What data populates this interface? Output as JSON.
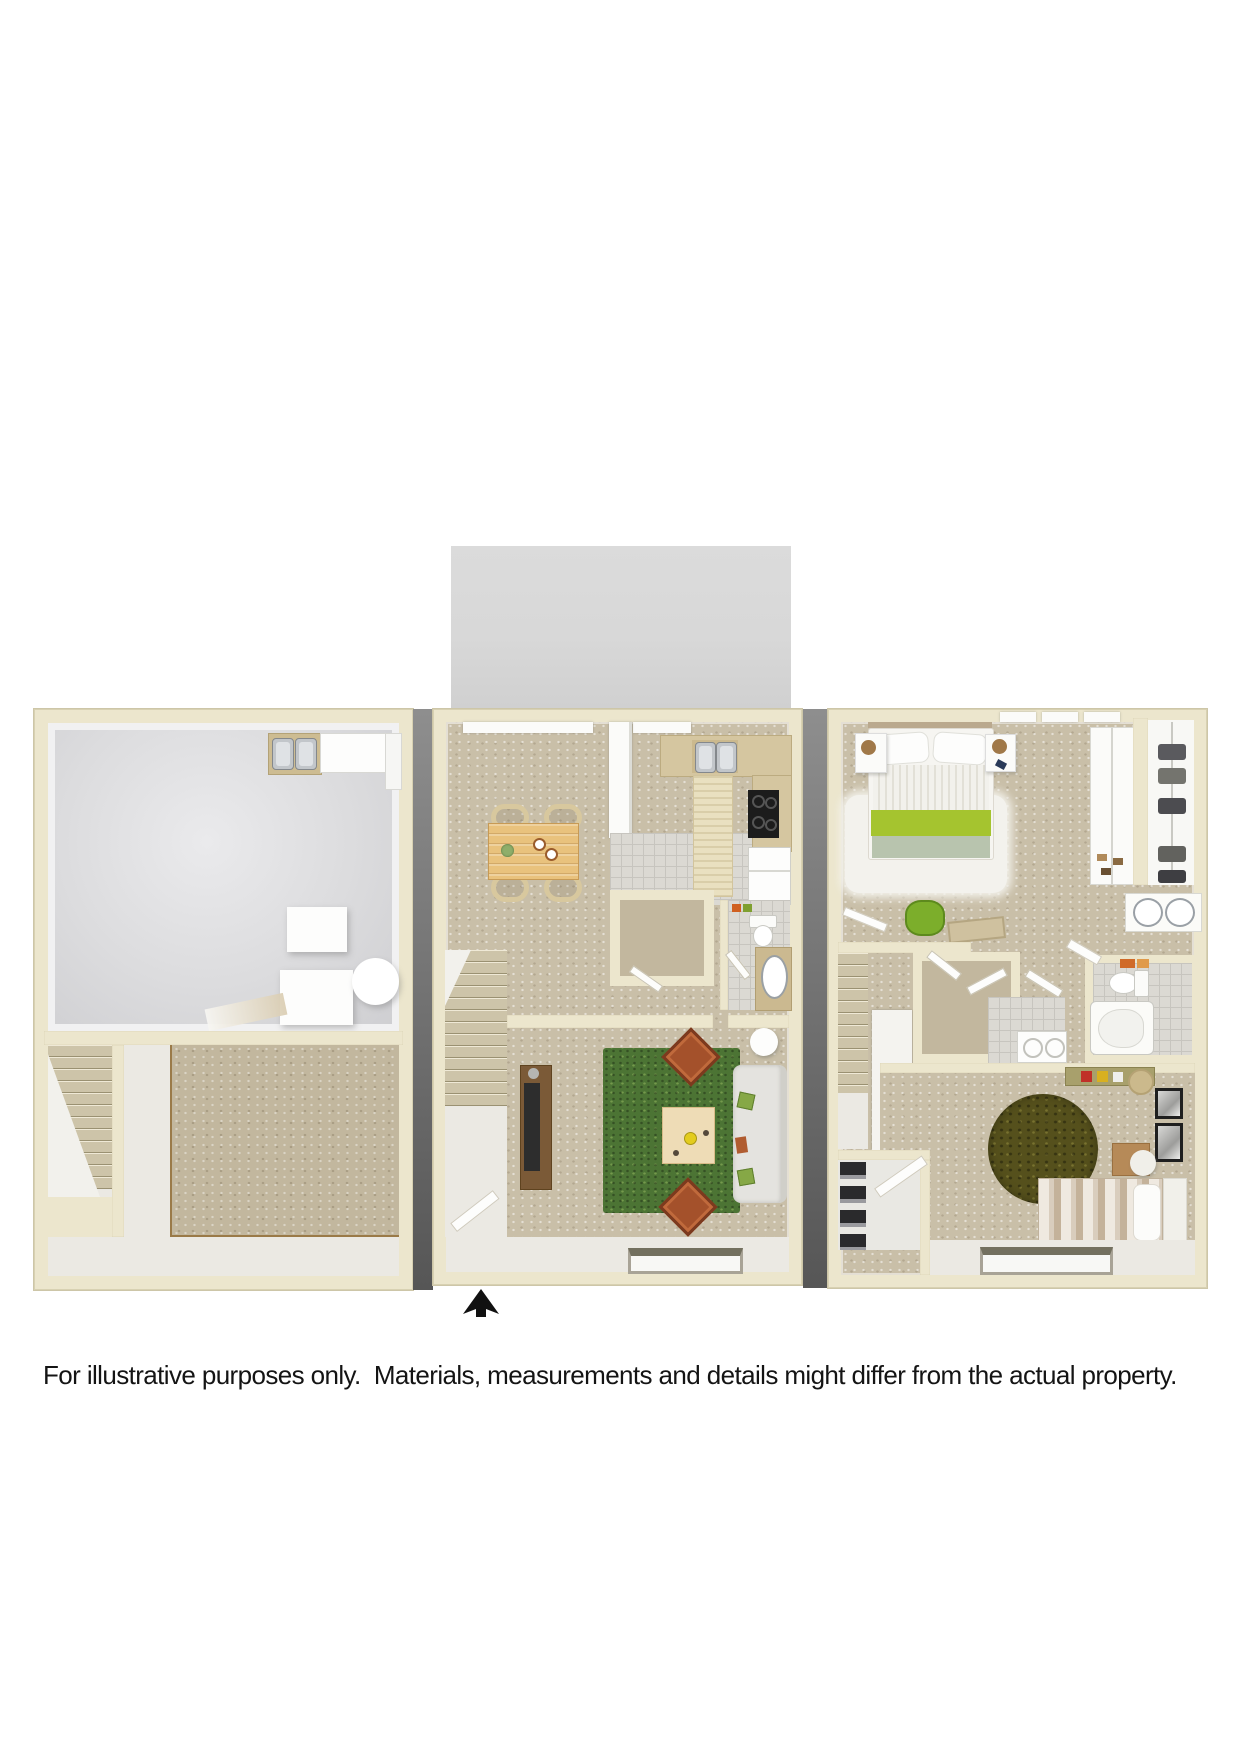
{
  "disclaimer": {
    "text": "For illustrative purposes only.  Materials, measurements and details might differ from the actual property."
  },
  "meta": {
    "figure": "three-level townhouse 3D floor plan rendering",
    "levels": [
      "basement-with-garage",
      "main-level-kitchen-dining-living",
      "upper-level-two-bedrooms-two-baths"
    ],
    "entry_arrow_icon": "up-arrow"
  },
  "palette": {
    "wall": "#ece6cd",
    "wallEdge": "#d8d1b2",
    "ink": "#111111",
    "grayBlock": "#d8d8d8",
    "carpet": "#c2b79e",
    "carpetLight": "#c9bfa8",
    "floorWhite": "#ebe9e3",
    "fluffy": "#f3f2ed",
    "tile": "#dbd9d3",
    "tileLine": "#c7c5bf",
    "stepTan": "#cdc4a9",
    "stepDark": "#9a9172",
    "wood": "#e9c27d",
    "woodDark": "#c79a55",
    "rust": "#a4512b",
    "rustDark": "#7c3a1e",
    "sofa": "#e4e3df",
    "greenRug": "#4c7434",
    "oliveRug": "#55501c",
    "runner": "#e9e0c0",
    "steel": "#c2c6ca",
    "counterTan": "#d5c6a0",
    "bedGreen": "#a5c42f",
    "bedSage": "#b8c4ae",
    "bagGreen": "#7cae2b",
    "garageHi": "#eaeaec",
    "garageLo": "#cfcfd2",
    "shadowHi": "#8e8e8e",
    "shadowLo": "#565656"
  }
}
